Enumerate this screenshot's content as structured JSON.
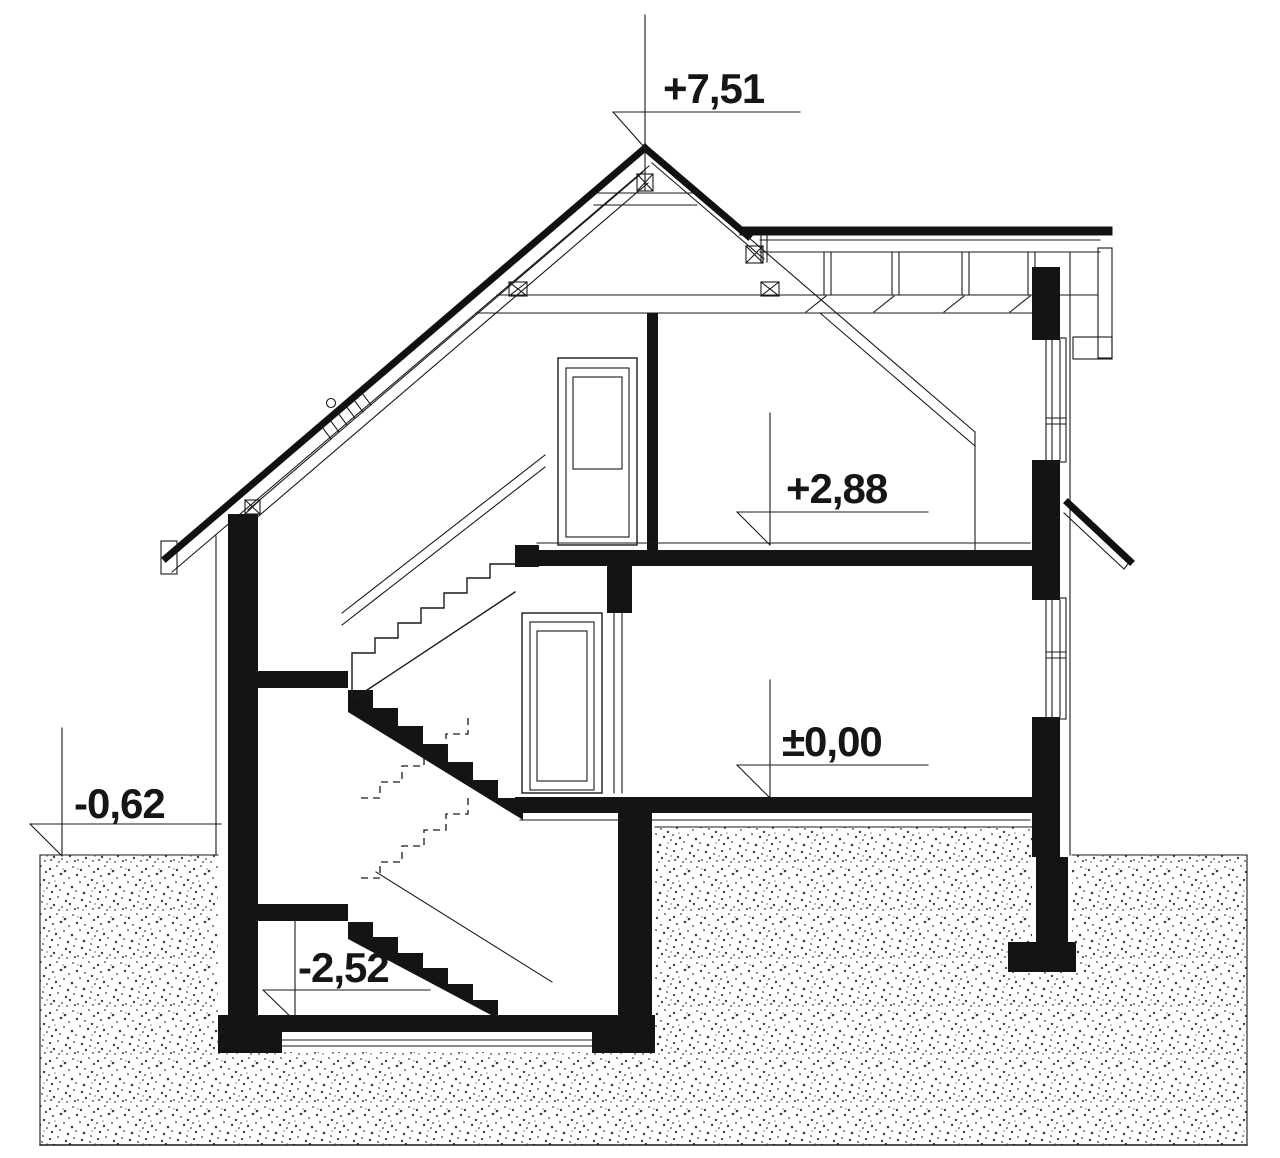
{
  "drawing": {
    "title": "House cross-section (przekrój)",
    "type": "architectural-section",
    "levels": [
      {
        "id": "ridge",
        "label": "+7,51"
      },
      {
        "id": "upper-floor",
        "label": "+2,88"
      },
      {
        "id": "ground-floor",
        "label": "±0,00"
      },
      {
        "id": "grade",
        "label": "-0,62"
      },
      {
        "id": "basement",
        "label": "-2,52"
      }
    ],
    "colors": {
      "line": "#1a1a1a",
      "fill": "#141414",
      "background": "#ffffff"
    }
  }
}
